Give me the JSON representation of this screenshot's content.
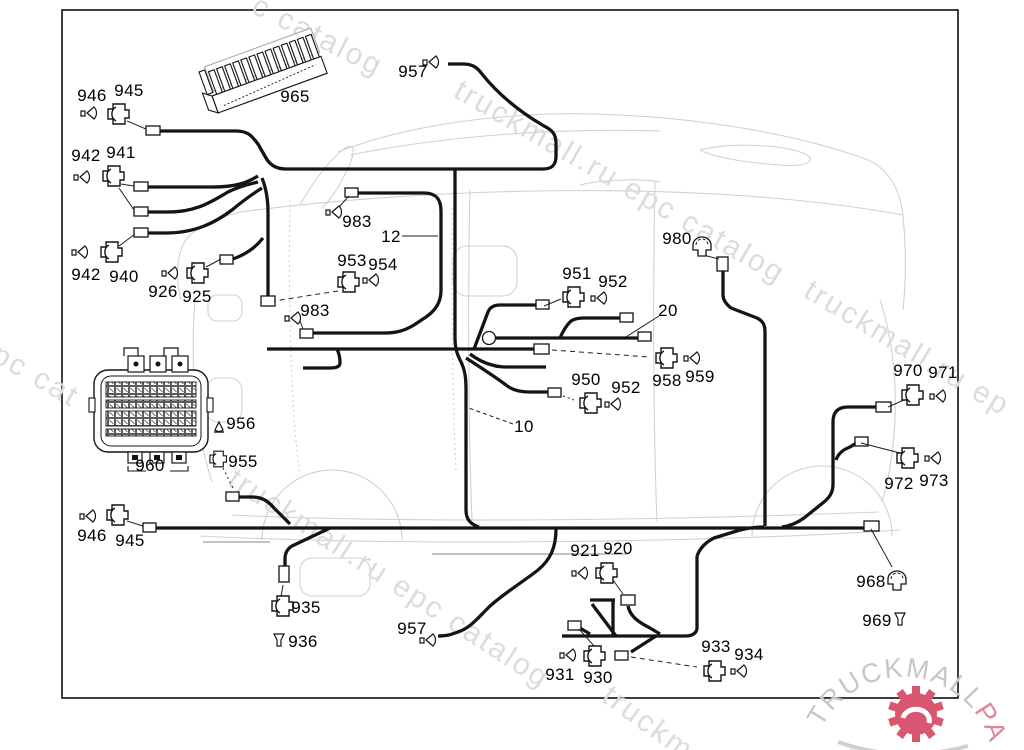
{
  "diagram": {
    "type": "wiring-harness parts diagram",
    "callouts": [
      "946",
      "945",
      "942",
      "941",
      "942",
      "940",
      "926",
      "925",
      "965",
      "957",
      "983",
      "12",
      "953",
      "954",
      "983",
      "951",
      "952",
      "980",
      "20",
      "950",
      "952",
      "958",
      "959",
      "10",
      "960",
      "956",
      "955",
      "946",
      "945",
      "935",
      "936",
      "957",
      "921",
      "920",
      "931",
      "930",
      "933",
      "934",
      "968",
      "969",
      "970",
      "971",
      "972",
      "973"
    ],
    "watermarks": [
      "c catalog",
      "truckmall.ru epc catalog",
      "truckmall.ru ep",
      "ll epc cat",
      "truckmall.ru epc catalog",
      "truckm"
    ],
    "logo": {
      "brand": "TRUCKMALL",
      "brand_accent": "PARTS"
    },
    "icons": [
      "connector-housing-icon",
      "pin-plug-icon",
      "cover-cap-icon",
      "grommet-icon",
      "fuse-strip-icon",
      "multi-pin-connector-icon",
      "ring-terminal-icon",
      "gear-logo-icon"
    ],
    "colors": {
      "line": "#141414",
      "body_outline": "#cdcdcd",
      "watermark": "#dcdcdc",
      "logo_gray": "#c6c6c6",
      "logo_pink": "#e2849a",
      "logo_gear": "#d95670"
    }
  }
}
